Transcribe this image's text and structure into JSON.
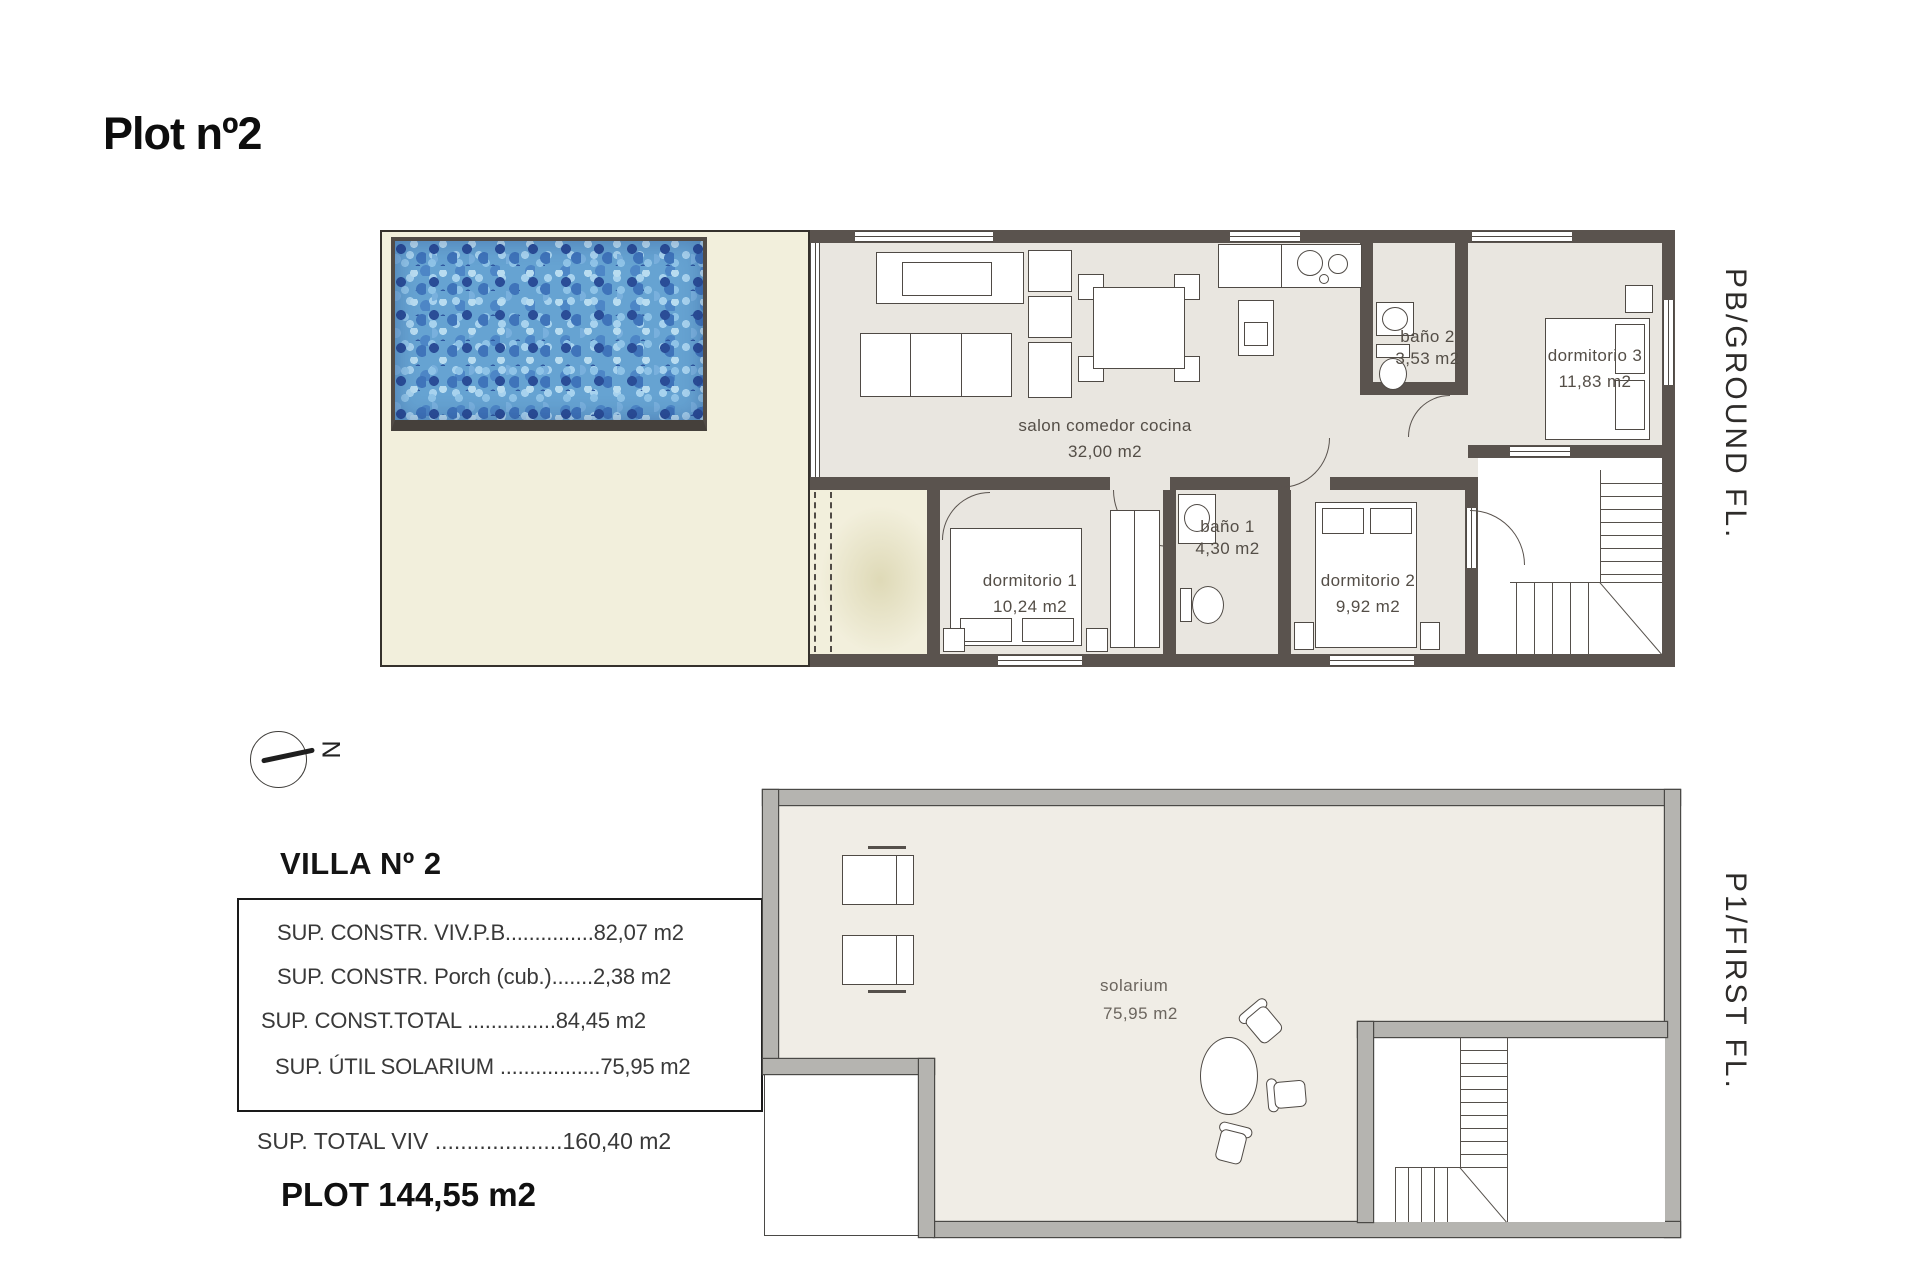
{
  "title": "Plot nº2",
  "compass": {
    "north_label": "N"
  },
  "floors": {
    "ground": {
      "side_label": "PB/GROUND FL.",
      "rooms": {
        "salon": {
          "name": "salon comedor cocina",
          "area": "32,00 m2"
        },
        "bano2": {
          "name": "baño 2",
          "area": "3,53 m2"
        },
        "dorm3": {
          "name": "dormitorio 3",
          "area": "11,83 m2"
        },
        "dorm1": {
          "name": "dormitorio 1",
          "area": "10,24 m2"
        },
        "bano1": {
          "name": "baño 1",
          "area": "4,30 m2"
        },
        "dorm2": {
          "name": "dormitorio 2",
          "area": "9,92 m2"
        }
      }
    },
    "first": {
      "side_label": "P1/FIRST FL.",
      "rooms": {
        "solarium": {
          "name": "solarium",
          "area": "75,95 m2"
        }
      }
    }
  },
  "summary": {
    "heading": "VILLA Nº 2",
    "rows": [
      {
        "label": "SUP. CONSTR. VIV.P.B",
        "dots": "...............",
        "value": "82,07 m2"
      },
      {
        "label": "SUP. CONSTR. Porch (cub.)",
        "dots": ".......",
        "value": "2,38 m2"
      },
      {
        "label": "SUP. CONST.TOTAL ",
        "dots": "...............",
        "value": "84,45 m2"
      },
      {
        "label": "SUP. ÚTIL SOLARIUM ",
        "dots": ".................",
        "value": "75,95 m2"
      }
    ],
    "total": {
      "label": "SUP. TOTAL VIV ",
      "dots": "....................",
      "value": "160,40 m2"
    },
    "plot": "PLOT 144,55 m2"
  },
  "colors": {
    "wall": "#5a534e",
    "interior_floor": "#e9e6e0",
    "garden": "#f2efdc",
    "pool_base": "#66a3d2",
    "first_floor_wall": "#b5b4b0",
    "text": "#2d2a27"
  }
}
